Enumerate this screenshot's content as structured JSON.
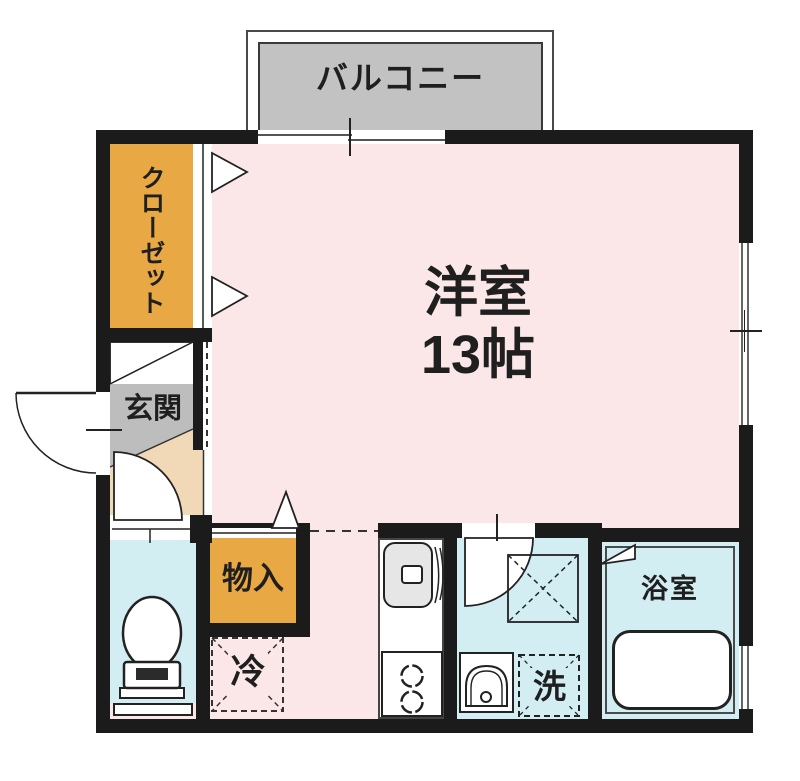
{
  "floorplan": {
    "balcony": {
      "label": "バルコニー"
    },
    "main_room": {
      "label": "洋室",
      "size": "13帖"
    },
    "closet": {
      "label": "クローゼット"
    },
    "entrance": {
      "label": "玄関"
    },
    "storage": {
      "label": "物入"
    },
    "refrigerator": {
      "label": "冷"
    },
    "laundry": {
      "label": "洗"
    },
    "bathroom": {
      "label": "浴室"
    },
    "colors": {
      "wall": "#1b1b1b",
      "room_pink": "#fbe7e7",
      "closet_orange": "#e8a843",
      "entrance_gray": "#bdbdbd",
      "balcony_gray": "#c2c2c2",
      "wet_area_blue": "#d2eef3",
      "step_beige": "#f1d9b7"
    }
  }
}
